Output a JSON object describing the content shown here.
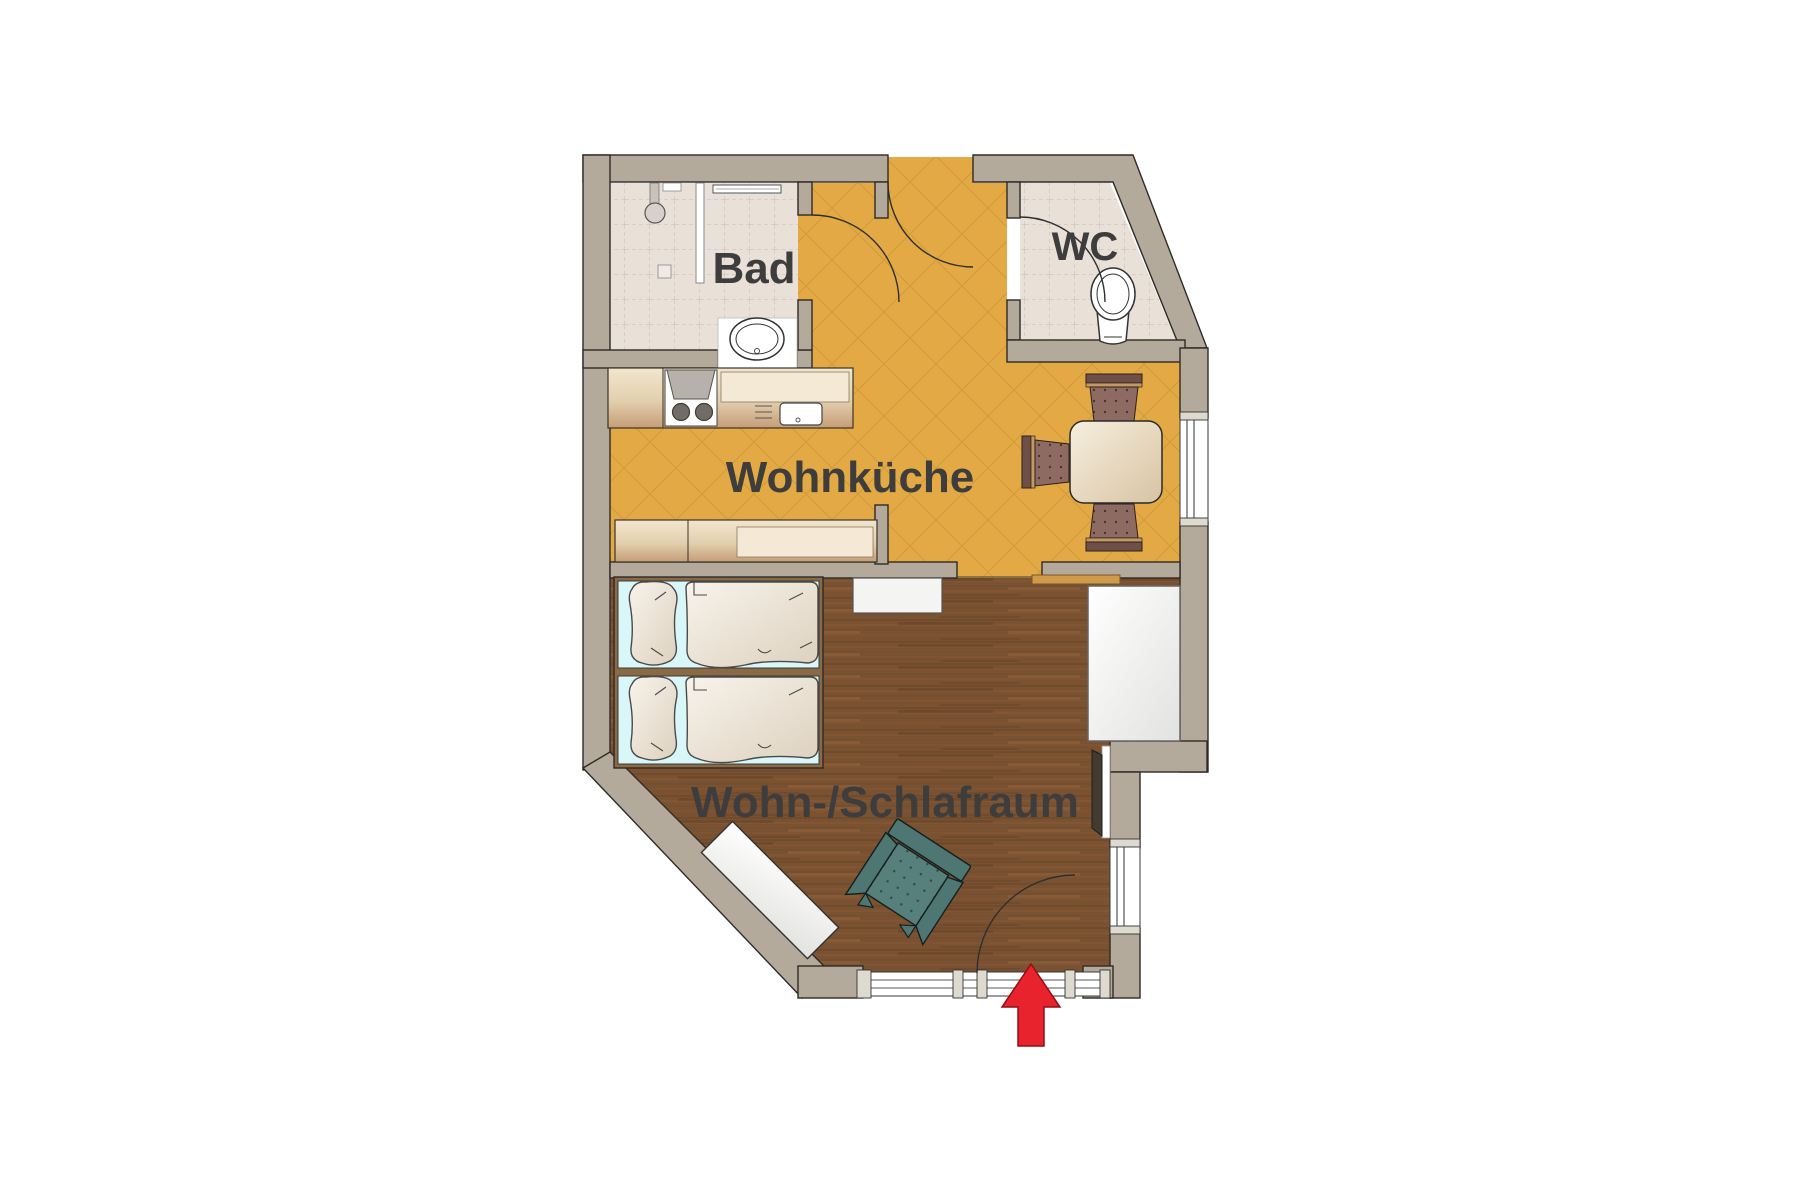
{
  "plan": {
    "type": "apartment-floor-plan",
    "rooms": {
      "bathroom": {
        "label": "Bad"
      },
      "toilet": {
        "label": "WC"
      },
      "kitchen": {
        "label": "Wohnküche"
      },
      "living": {
        "label": "Wohn-/Schlafraum"
      }
    },
    "entrance": {
      "marker": "red-arrow",
      "direction": "up"
    },
    "colors": {
      "wall": "#b3aa9c",
      "tile_floor": "#e9e1d8",
      "kitchen_floor": "#e2a944",
      "wood_floor": "#7a5232",
      "bed_base": "#d9f6f8",
      "chair": "#8d6b63",
      "armchair": "#577f7c",
      "arrow_red": "#e8232d",
      "label_text": "#3e3d3d"
    }
  }
}
